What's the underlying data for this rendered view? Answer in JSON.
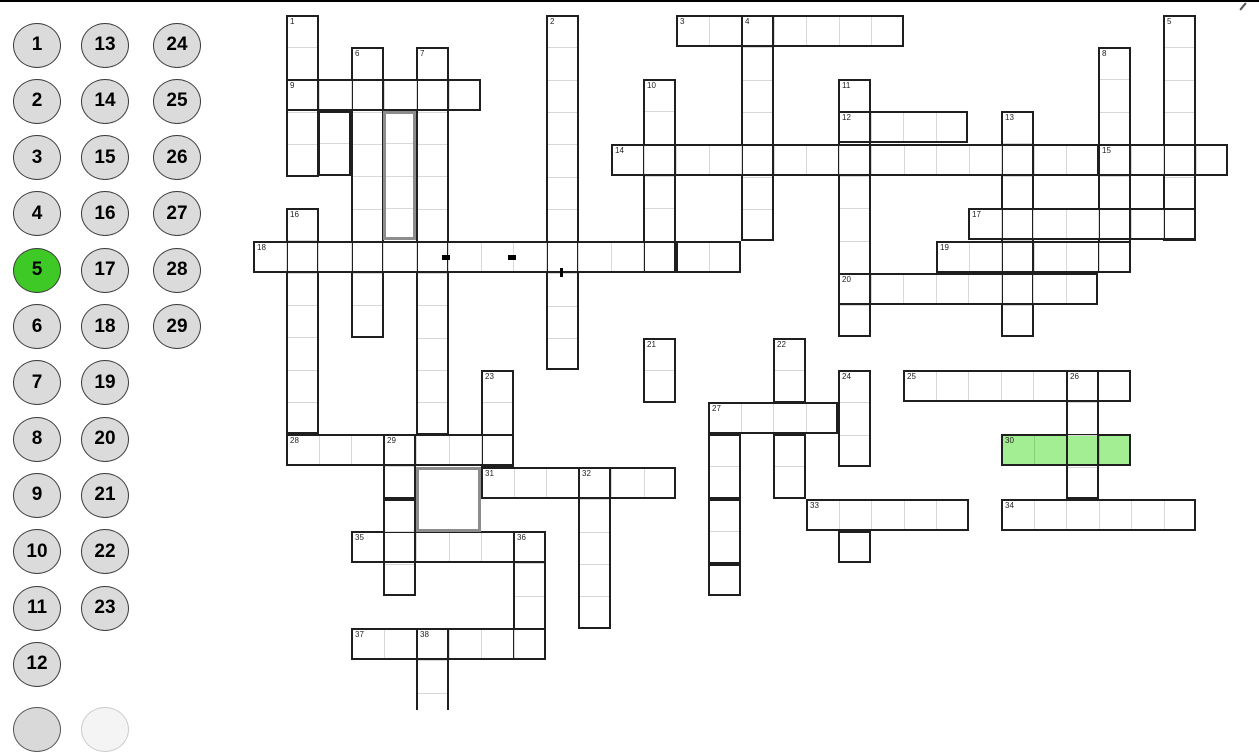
{
  "app": {
    "top_border_color": "#000000",
    "background": "#ffffff"
  },
  "sidebar": {
    "selected_number": "5",
    "circle": {
      "width": 48,
      "height": 45,
      "start_cy": 45,
      "step_cy": 56.3,
      "fill": "#dbdbdb",
      "border_color": "#3c3c3c",
      "selected_fill": "#3ec926",
      "text_color": "#000000"
    },
    "columns": [
      {
        "cx": 37,
        "numbers": [
          "1",
          "2",
          "3",
          "4",
          "5",
          "6",
          "7",
          "8",
          "9",
          "10",
          "11",
          "12"
        ]
      },
      {
        "cx": 105,
        "numbers": [
          "13",
          "14",
          "15",
          "16",
          "17",
          "18",
          "19",
          "20",
          "21",
          "22",
          "23"
        ]
      },
      {
        "cx": 177,
        "numbers": [
          "24",
          "25",
          "26",
          "27",
          "28",
          "29"
        ]
      }
    ],
    "partial_circles": [
      {
        "cx": 37,
        "cy": 729,
        "fill": "#d9d9d9",
        "border_color": "#555555"
      },
      {
        "cx": 105,
        "cy": 729,
        "fill": "#f4f4f4",
        "border_color": "#cccccc"
      }
    ]
  },
  "grid": {
    "origin_x": 253,
    "origin_y": 14.5,
    "cell_w": 32.5,
    "cell_h": 32.3,
    "line_color": "#1f1f1f",
    "line_px": 2,
    "gray_line_color": "#8c8c8c",
    "gray_line_px": 3,
    "divider_color": "#d8d8d8",
    "highlight_fill": "#a3ee93",
    "highlight_divider": "#86d178",
    "slots": [
      {
        "n": "30",
        "c": 23,
        "r": 13,
        "w": 4,
        "h": 1,
        "style": "black",
        "fill": "#a3ee93",
        "highlight": true
      },
      {
        "n": "1",
        "c": 1,
        "r": 0,
        "w": 1,
        "h": 5,
        "style": "black"
      },
      {
        "n": "2",
        "c": 9,
        "r": 0,
        "w": 1,
        "h": 11,
        "style": "black"
      },
      {
        "n": "3",
        "c": 13,
        "r": 0,
        "w": 7,
        "h": 1,
        "style": "black"
      },
      {
        "n": "4",
        "c": 15,
        "r": 0,
        "w": 1,
        "h": 7,
        "style": "black"
      },
      {
        "n": "5",
        "c": 28,
        "r": 0,
        "w": 1,
        "h": 7,
        "style": "black"
      },
      {
        "n": "6",
        "c": 3,
        "r": 1,
        "w": 1,
        "h": 9,
        "style": "black"
      },
      {
        "n": "7",
        "c": 5,
        "r": 1,
        "w": 1,
        "h": 12,
        "style": "black"
      },
      {
        "n": "8",
        "c": 26,
        "r": 1,
        "w": 1,
        "h": 7,
        "style": "black"
      },
      {
        "n": "9",
        "c": 1,
        "r": 2,
        "w": 6,
        "h": 1,
        "style": "black"
      },
      {
        "n": "10",
        "c": 12,
        "r": 2,
        "w": 1,
        "h": 6,
        "style": "black"
      },
      {
        "n": "11",
        "c": 18,
        "r": 2,
        "w": 1,
        "h": 8,
        "style": "black"
      },
      {
        "n": "12",
        "c": 18,
        "r": 3,
        "w": 4,
        "h": 1,
        "style": "black"
      },
      {
        "n": "13",
        "c": 23,
        "r": 3,
        "w": 1,
        "h": 7,
        "style": "black"
      },
      {
        "n": "14",
        "c": 11,
        "r": 4,
        "w": 15,
        "h": 1,
        "style": "black"
      },
      {
        "n": "15",
        "c": 26,
        "r": 4,
        "w": 4,
        "h": 1,
        "style": "black"
      },
      {
        "n": "16",
        "c": 1,
        "r": 6,
        "w": 1,
        "h": 7,
        "style": "black"
      },
      {
        "n": "17",
        "c": 22,
        "r": 6,
        "w": 7,
        "h": 1,
        "style": "black"
      },
      {
        "n": "18",
        "c": 0,
        "r": 7,
        "w": 13,
        "h": 1,
        "style": "black"
      },
      {
        "n": "19",
        "c": 21,
        "r": 7,
        "w": 6,
        "h": 1,
        "style": "black"
      },
      {
        "n": "20",
        "c": 18,
        "r": 8,
        "w": 8,
        "h": 1,
        "style": "black"
      },
      {
        "n": "21",
        "c": 12,
        "r": 10,
        "w": 1,
        "h": 2,
        "style": "black"
      },
      {
        "n": "22",
        "c": 16,
        "r": 10,
        "w": 1,
        "h": 2,
        "style": "black"
      },
      {
        "n": "23",
        "c": 7,
        "r": 11,
        "w": 1,
        "h": 3,
        "style": "black"
      },
      {
        "n": "24",
        "c": 18,
        "r": 11,
        "w": 1,
        "h": 3,
        "style": "black"
      },
      {
        "n": "25",
        "c": 20,
        "r": 11,
        "w": 7,
        "h": 1,
        "style": "black"
      },
      {
        "n": "26",
        "c": 25,
        "r": 11,
        "w": 1,
        "h": 4,
        "style": "black"
      },
      {
        "n": "27",
        "c": 14,
        "r": 12,
        "w": 4,
        "h": 1,
        "style": "black"
      },
      {
        "n": "28",
        "c": 1,
        "r": 13,
        "w": 7,
        "h": 1,
        "style": "black"
      },
      {
        "n": "29",
        "c": 4,
        "r": 13,
        "w": 1,
        "h": 2,
        "style": "black"
      },
      {
        "n": "31",
        "c": 7,
        "r": 14,
        "w": 6,
        "h": 1,
        "style": "black"
      },
      {
        "n": "32",
        "c": 10,
        "r": 14,
        "w": 1,
        "h": 5,
        "style": "black"
      },
      {
        "n": "33",
        "c": 17,
        "r": 15,
        "w": 5,
        "h": 1,
        "style": "black"
      },
      {
        "n": "34",
        "c": 23,
        "r": 15,
        "w": 6,
        "h": 1,
        "style": "black"
      },
      {
        "n": "35",
        "c": 3,
        "r": 16,
        "w": 6,
        "h": 1,
        "style": "black"
      },
      {
        "n": "36",
        "c": 8,
        "r": 16,
        "w": 1,
        "h": 4,
        "style": "black"
      },
      {
        "n": "37",
        "c": 3,
        "r": 19,
        "w": 6,
        "h": 1,
        "style": "black"
      },
      {
        "n": "38",
        "c": 5,
        "r": 19,
        "w": 1,
        "h": 3,
        "style": "black",
        "cut_bottom_y": 710
      }
    ],
    "extra_boxes": [
      {
        "c": 2,
        "r": 3,
        "w": 1,
        "h": 2,
        "style": "black"
      },
      {
        "c": 4,
        "r": 3,
        "w": 1,
        "h": 4,
        "style": "gray"
      },
      {
        "c": 5,
        "r": 14,
        "w": 2,
        "h": 2,
        "style": "gray",
        "dividers": false
      },
      {
        "c": 13,
        "r": 7,
        "w": 2,
        "h": 1,
        "style": "black"
      },
      {
        "c": 16,
        "r": 13,
        "w": 1,
        "h": 2,
        "style": "black"
      },
      {
        "c": 14,
        "r": 13,
        "w": 1,
        "h": 2,
        "style": "black"
      },
      {
        "c": 14,
        "r": 15,
        "w": 1,
        "h": 2,
        "style": "black"
      },
      {
        "c": 14,
        "r": 17,
        "w": 1,
        "h": 1,
        "style": "black"
      },
      {
        "c": 4,
        "r": 15,
        "w": 1,
        "h": 3,
        "style": "black"
      },
      {
        "c": 18,
        "r": 16,
        "w": 1,
        "h": 1,
        "style": "black"
      }
    ],
    "marks": [
      {
        "x": 442,
        "y": 255,
        "w": 8,
        "h": 5
      },
      {
        "x": 508,
        "y": 255,
        "w": 8,
        "h": 5
      },
      {
        "x": 560,
        "y": 268,
        "w": 3,
        "h": 9
      }
    ],
    "cursor_artifact": {
      "x": 1242,
      "y": 2
    }
  }
}
